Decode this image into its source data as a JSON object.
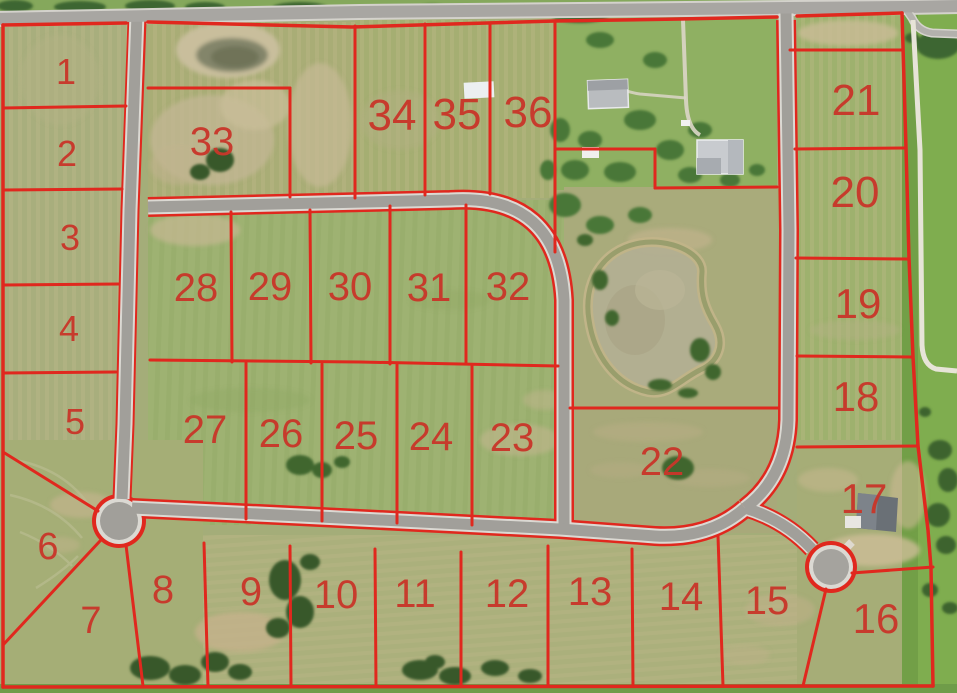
{
  "map": {
    "lot_labels": [
      "1",
      "2",
      "3",
      "4",
      "5",
      "6",
      "7",
      "8",
      "9",
      "10",
      "11",
      "12",
      "13",
      "14",
      "15",
      "16",
      "17",
      "18",
      "19",
      "20",
      "21",
      "22",
      "23",
      "24",
      "25",
      "26",
      "27",
      "28",
      "29",
      "30",
      "31",
      "32",
      "33",
      "34",
      "35",
      "36"
    ]
  },
  "colors": {
    "boundary_line_red": "#e0281e",
    "lot_number_red": "#c8372a",
    "road_surface_gray": "#a8a6a2",
    "field_green": "#a4ad79",
    "lawn_green": "#8fb062",
    "pond_water": "#b3af92",
    "tree_green": "#3e6630"
  }
}
